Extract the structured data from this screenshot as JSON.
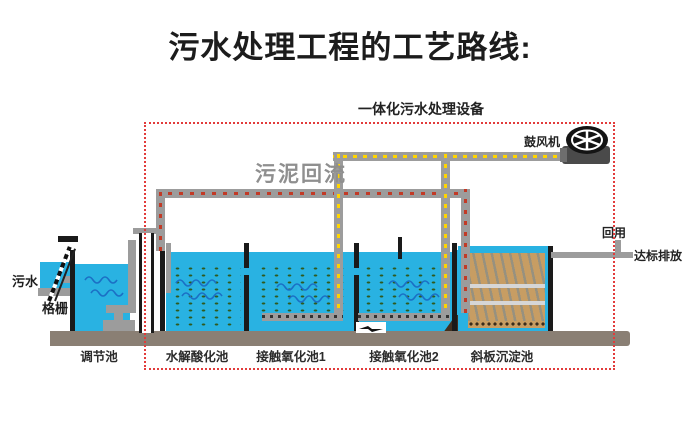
{
  "title": "污水处理工程的工艺路线:",
  "equipment_label": "一体化污水处理设备",
  "blower_label": "鼓风机",
  "sludge_return_label": "污泥回流",
  "influent_label": "污水",
  "screen_label": "格栅",
  "reuse_label": "回用",
  "discharge_label": "达标排放",
  "tanks": [
    {
      "label": "调节池"
    },
    {
      "label": "水解酸化池"
    },
    {
      "label": "接触氧化池1"
    },
    {
      "label": "接触氧化池2"
    },
    {
      "label": "斜板沉淀池"
    }
  ],
  "colors": {
    "water": "#29b2e2",
    "pipe": "#9c9c9c",
    "air_arrow": "#ffd400",
    "sludge_arrow": "#c23a26",
    "boundary_box": "#e23b3b",
    "bio_media_dots": "#2f5a1e",
    "inclined_plates": "#c79d63",
    "base_platform": "#8a7f74"
  }
}
